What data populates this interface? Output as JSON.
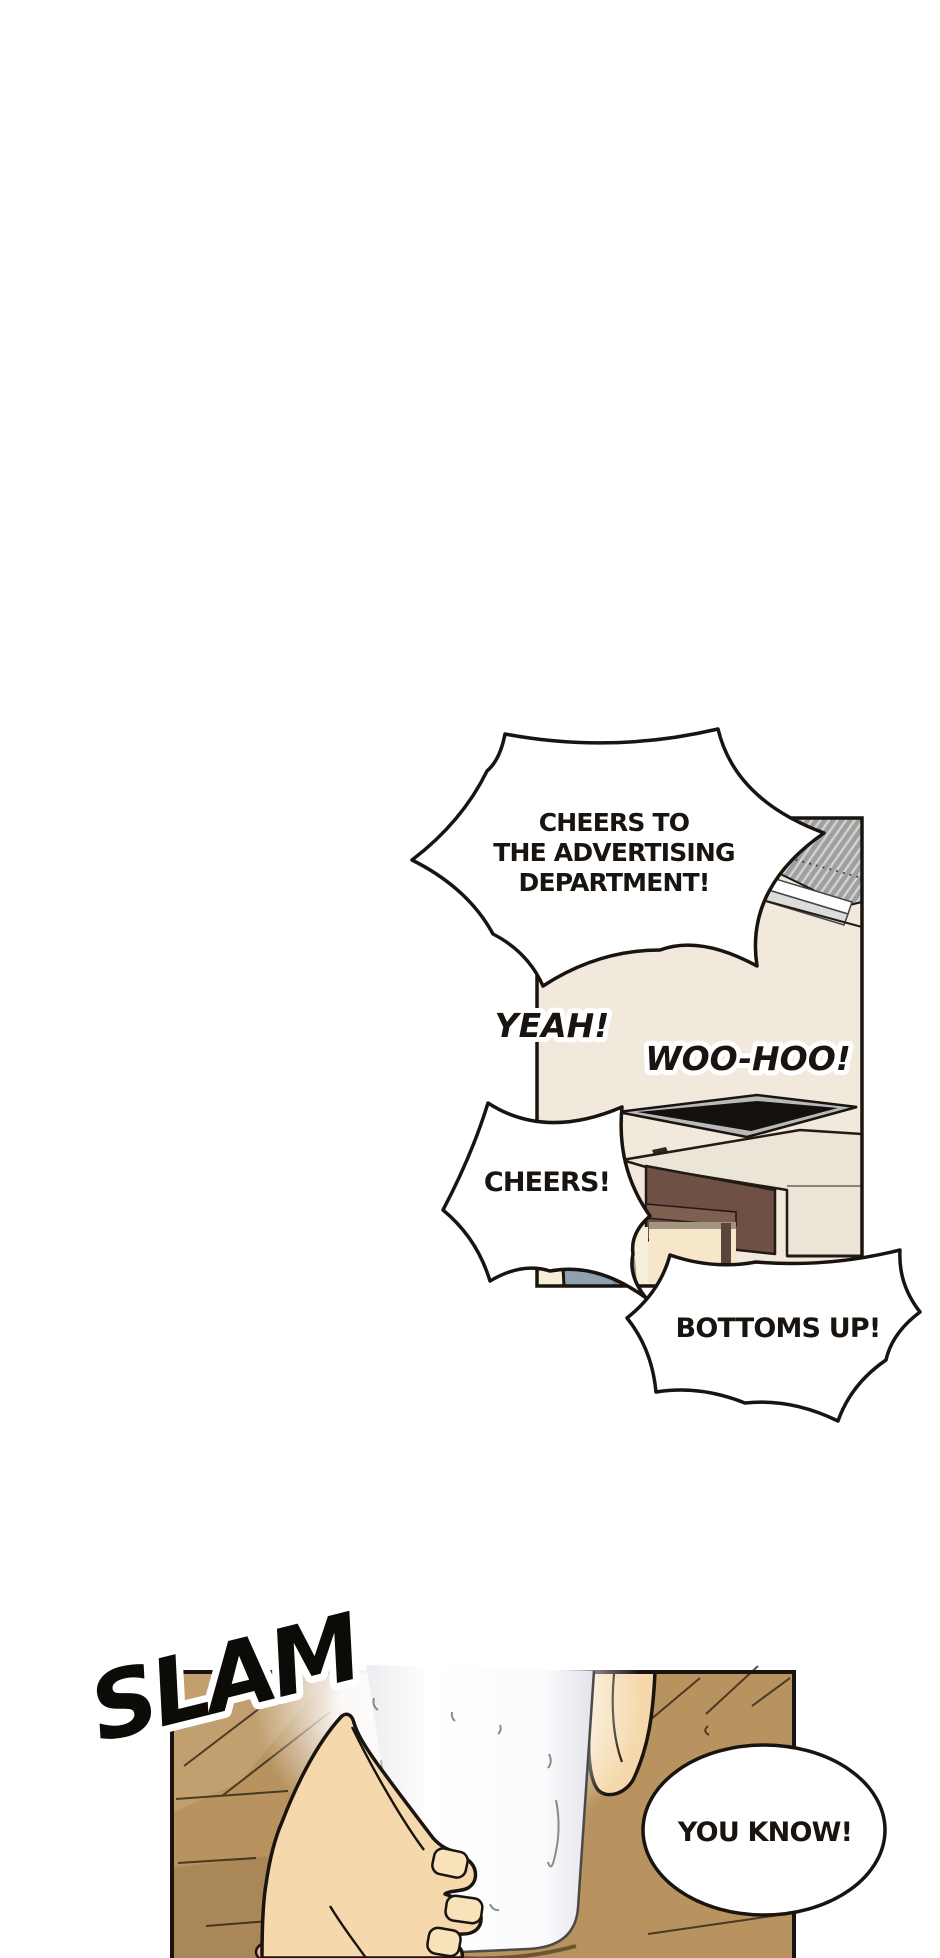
{
  "comic": {
    "panel1": {
      "speech": {
        "toast_line1": "CHEERS TO",
        "toast_line2": "THE ADVERTISING",
        "toast_line3": "DEPARTMENT!",
        "yeah": "YEAH!",
        "woohoo": "WOO-HOO!",
        "cheers": "CHEERS!",
        "bottoms_up": "BOTTOMS UP!"
      },
      "colors": {
        "wall": "#f0e9dc",
        "ceiling_gray": "#9f9f9f",
        "vent_light": "#dcdcdc",
        "tv_screen": "#14100d",
        "tv_frame": "#b9b9b9",
        "cabinet_beige": "#ebe5d7",
        "cabinet_brown": "#6e5044",
        "shelf_brown": "#7e5f50",
        "alcove_cream": "#f6e7ca",
        "desk_cream": "#f7eed8",
        "monitor_gray": "#90a0ae"
      }
    },
    "panel2": {
      "speech": {
        "you_know": "YOU KNOW!"
      },
      "sfx": {
        "slam": "SLAM"
      },
      "colors": {
        "wood": "#b8935f",
        "wood_light": "#c9a97c",
        "skin": "#f5d9ac",
        "nail": "#f8e2ba",
        "glass_edge": "#e3e3ea",
        "pink": "#f0b49e"
      }
    },
    "bubble": {
      "fill": "#ffffff",
      "stroke": "#19140f"
    },
    "page_background": "#ffffff"
  }
}
